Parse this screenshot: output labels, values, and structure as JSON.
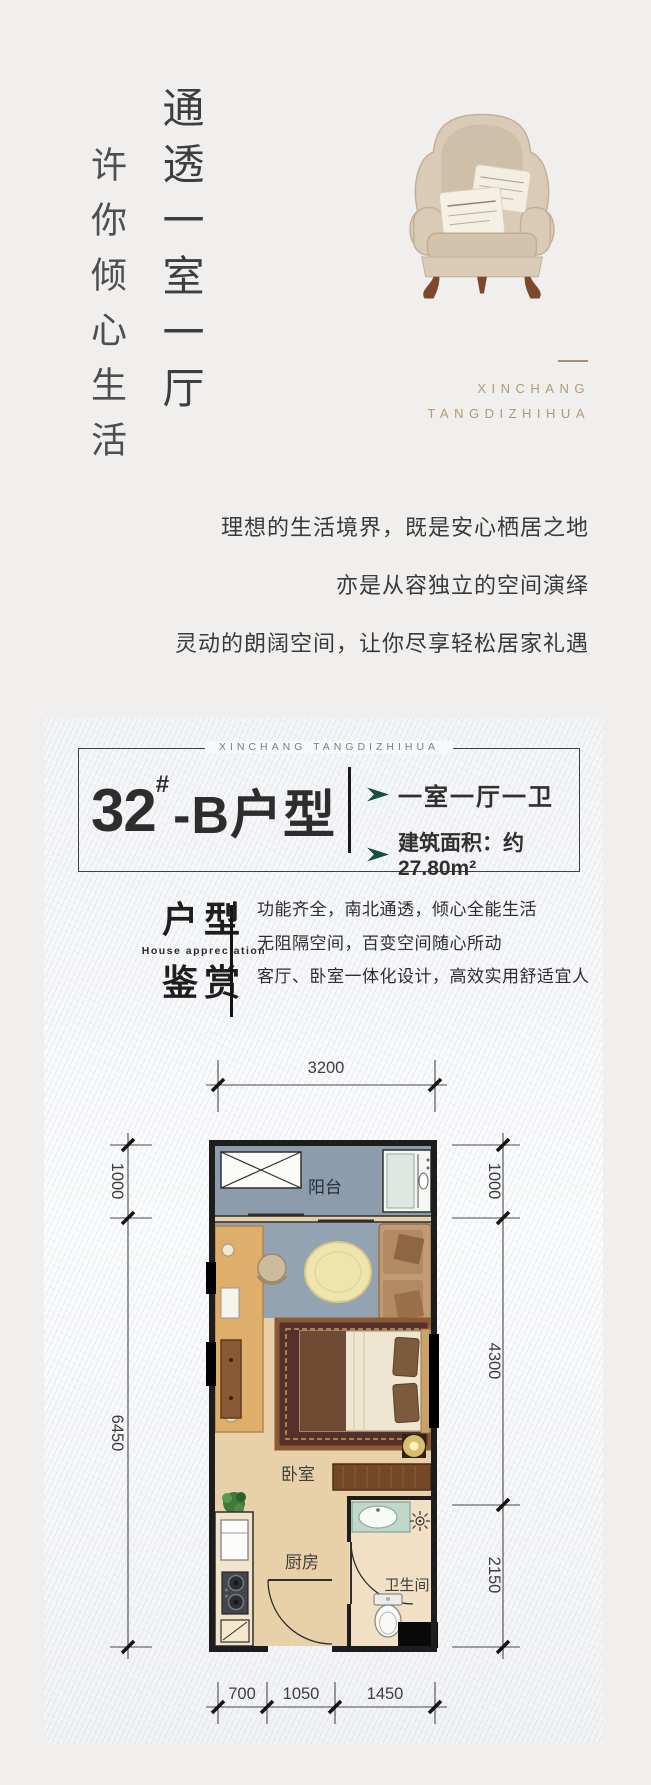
{
  "colors": {
    "page_bg": "#f0efed",
    "gold": "#a8906b",
    "accent_green": "#15503e",
    "balcony_floor": "#8c9cad",
    "wood_floor": "#e8d0a9"
  },
  "hero": {
    "slogan_secondary": "许你倾心生活",
    "slogan_primary": "通透一室一厅",
    "brand_en_1": "XINCHANG",
    "brand_en_2": "TANGDIZHIHUA"
  },
  "intro": {
    "line1": "理想的生活境界，既是安心栖居之地",
    "line2": "亦是从容独立的空间演绎",
    "line3": "灵动的朗阔空间，让你尽享轻松居家礼遇"
  },
  "unit_card": {
    "brand_en": "XINCHANG TANGDIZHIHUA",
    "title_number": "32",
    "title_hash": "#",
    "title_suffix": "-B户型",
    "feature1": "一室一厅一卫",
    "feature2": "建筑面积：约27.80m²"
  },
  "appreciation": {
    "zh_top": "户型",
    "en": "House appreciation",
    "zh_bottom": "鉴赏",
    "line1": "功能齐全，南北通透，倾心全能生活",
    "line2": "无阻隔空间，百变空间随心所动",
    "line3": "客厅、卧室一体化设计，高效实用舒适宜人"
  },
  "floorplan": {
    "room_balcony": "阳台",
    "room_bedroom": "卧室",
    "room_kitchen": "厨房",
    "room_bathroom": "卫生间",
    "dim_top": "3200",
    "dim_left_1": "1000",
    "dim_left_2": "6450",
    "dim_right_1": "1000",
    "dim_right_2": "4300",
    "dim_right_3": "2150",
    "dim_bottom_1": "700",
    "dim_bottom_2": "1050",
    "dim_bottom_3": "1450"
  }
}
